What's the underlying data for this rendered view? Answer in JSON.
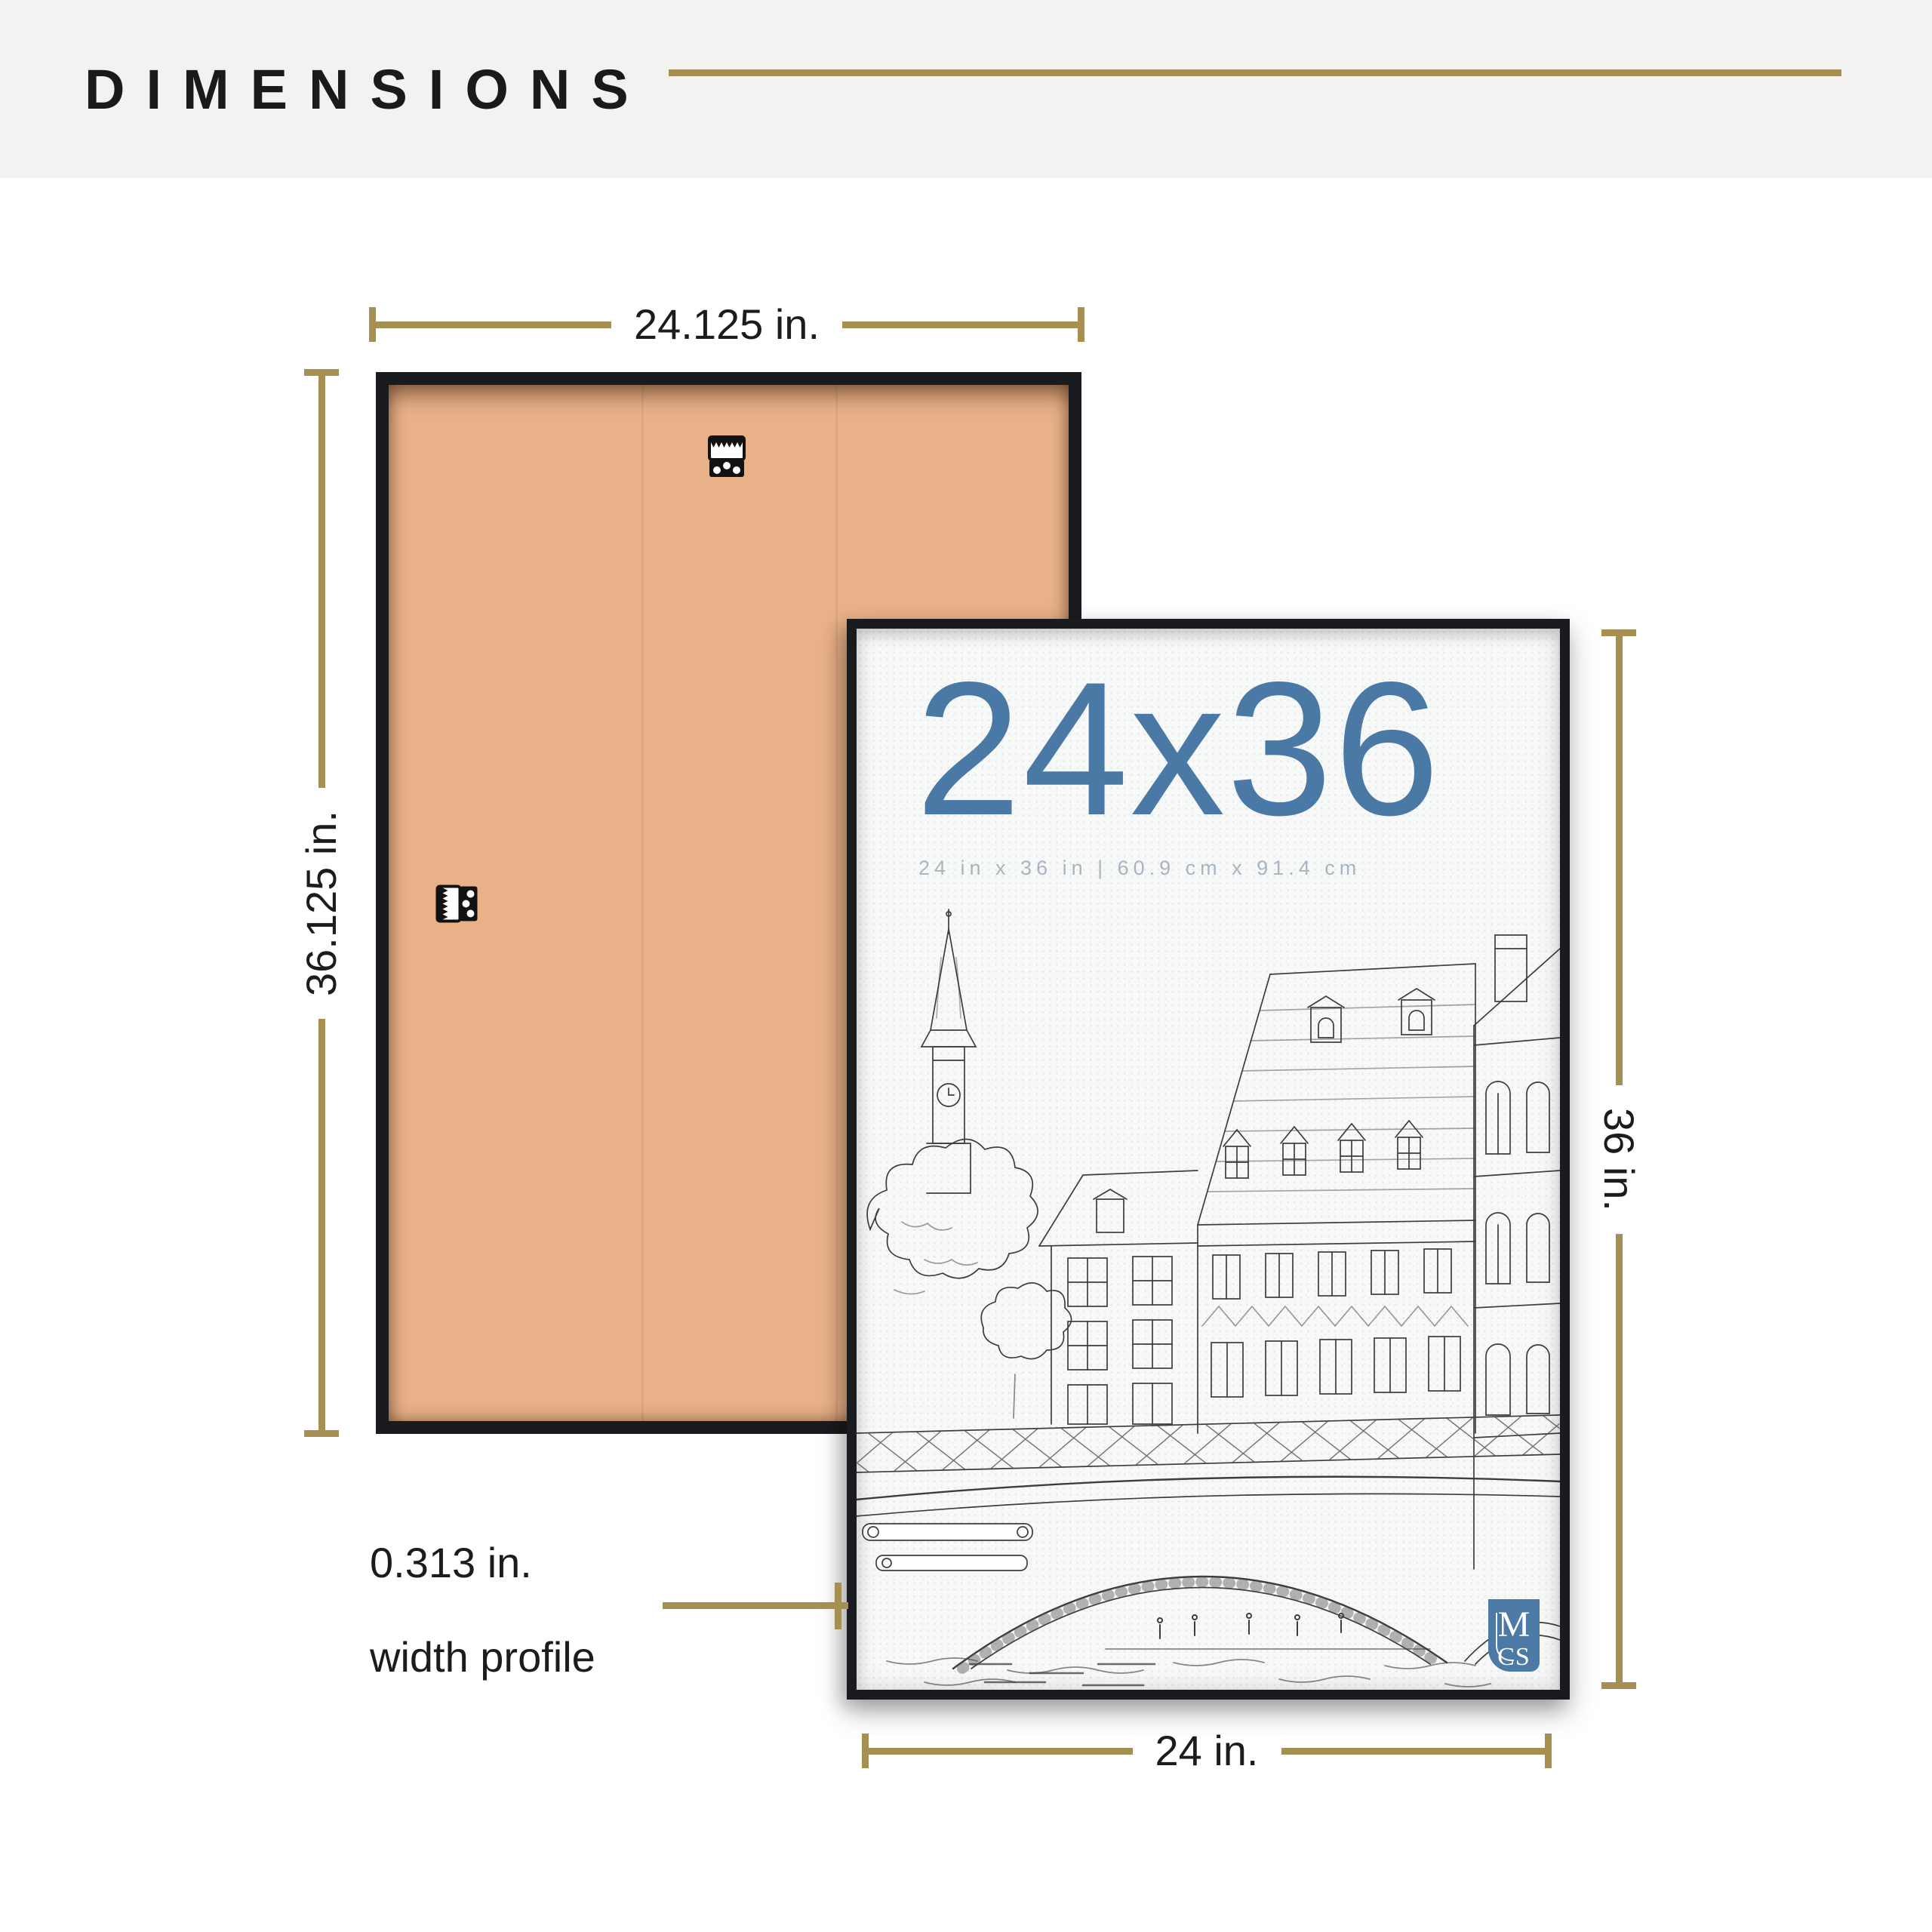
{
  "header": {
    "title": "DIMENSIONS"
  },
  "back_frame": {
    "width_label": "24.125 in.",
    "height_label": "36.125 in.",
    "hanger_icons": [
      "sawtooth-hanger-icon-top",
      "sawtooth-hanger-icon-side"
    ]
  },
  "front_frame": {
    "poster_title": "24x36",
    "poster_subtitle": "24 in x 36 in | 60.9 cm x 91.4 cm",
    "width_label": "24 in.",
    "height_label": "36 in.",
    "logo": {
      "top": "M",
      "bottom": "CS"
    }
  },
  "profile": {
    "line1": "0.313 in.",
    "line2": "width profile"
  },
  "colors": {
    "accent_gold": "#a68f52",
    "poster_blue": "#4b79a6",
    "cardboard_tan": "#e9b188",
    "frame_black": "#1a1b1e",
    "header_band_gray": "#f3f2f1",
    "subtitle_gray_blue": "#a7b6c1",
    "logo_blue": "#4c7aa4"
  }
}
